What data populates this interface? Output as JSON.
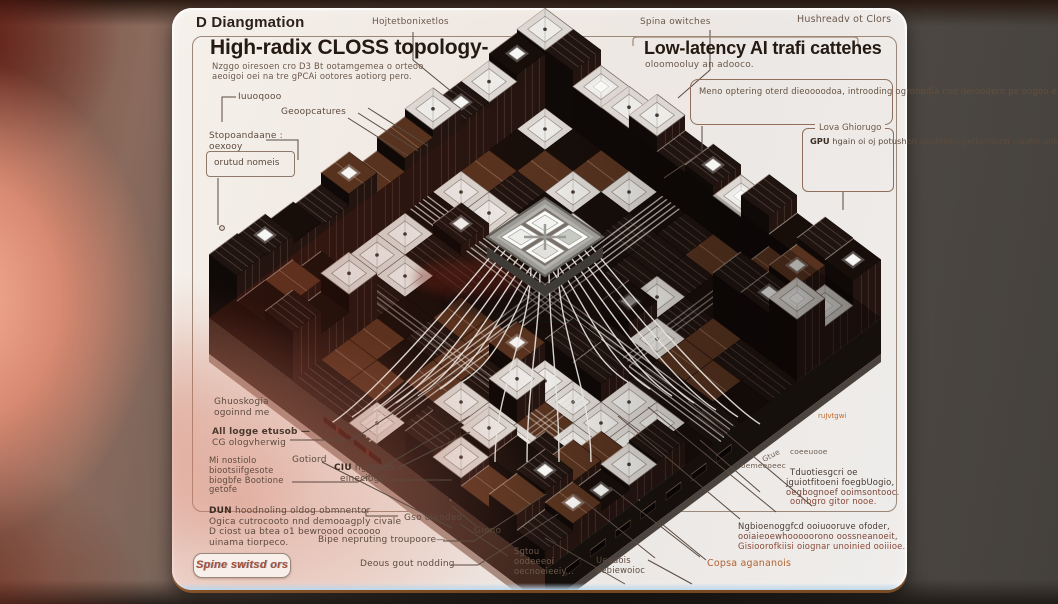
{
  "header": {
    "doc_label": "D Diangmation",
    "center_label": "Hojtetbonixetlos",
    "spine_label": "Spina owitches",
    "right_label": "Hushreadv ot Clors"
  },
  "left_panel": {
    "title": "High-radix CLOSS topology-",
    "subtitle_lines": [
      "Nzggo oiresoen cro D3 Bt ootamgemea o orteoo",
      "aeoigoi oei na tre gPCAi ootores aotiorg pero."
    ],
    "label_top": "Iuuoqooo",
    "label_geo": "Geoopcatures",
    "label_stop_lines": [
      "Stopoandaane :",
      "oexooy"
    ],
    "boxed_label": "orutud nomeis"
  },
  "right_panel": {
    "title": "Low-latency AI trafi cattehes",
    "subtitle": "oloomooluy an adooco.",
    "note_lines": [
      "Meno optering oterd dieoooodoa, introoding",
      "ogronbdia coo deroodero po oogoo enoatio,",
      "noprguroote oooo."
    ],
    "fieldset_legend": "Lova Ghiorugo",
    "fieldset_bold": "GPU",
    "fieldset_line1_rest": " hgain oi oj",
    "fieldset_lines": [
      "potushoit goofoiten",
      "gettoimond ciaofot",
      "onbuomoung ootnd"
    ]
  },
  "annotations_left": {
    "ghuo_lines": [
      "Ghuoskogia",
      "ogoinnd me"
    ],
    "all_lines": [
      "All logge etusob —",
      "CG ologvherwig"
    ],
    "gotiord": "Gotiord",
    "mi_lines": [
      "Mi nostiolo",
      "biootsiifgesote",
      "biogbfe Bootione",
      "getofe"
    ],
    "ciu_bold": "CIU",
    "ciu_rest": " hgeotob",
    "ciu_line2": "eineciogd",
    "dun_bold": "DUN",
    "dun_line1_rest": " hoodnoling oldog obmnentor",
    "dun_lines": [
      "Ogica cutrocooto nnd demooagply civale",
      "D ciost ua btea o1 bewroood ocoooo",
      "uinama tiorpeco."
    ],
    "gso": "Gso olendeo",
    "bipe": "Bipe nepruting troupoore—",
    "spine_box": "Spine switsd ors",
    "deous": "Deous gout nodding"
  },
  "annotations_center": {
    "gieno": "Gieno",
    "sgtou_lines": [
      "Sgtou",
      "oodeeeoi",
      "oecnoeieeiy..."
    ],
    "ueaa_lines": [
      "Ueaaois",
      "aebiewoioc"
    ],
    "copsa": "Copsa agananois",
    "ngb_lines": [
      "Ngbioenoggfcd ooiuooruve ofoder,",
      "ooiaieoewhooooorono oossneanoeit,",
      "Gisioorofkiisi oiognar unoinied ooiiioe."
    ]
  },
  "annotations_right": {
    "gtue": "Gtue",
    "coee": "coeeuooe",
    "oeme": "oemeeoeec",
    "para_lines": [
      "Tduotiesgcri oe",
      "jguiotfitoeni foegbUogio,",
      "oegbognoef ooimsontooc.",
      "oonbgro gitor nooe."
    ]
  },
  "illustration": {
    "port_label": "ruJvtgwi"
  },
  "colors": {
    "accent_orange": "#b3622f",
    "text_dark": "#2c211a",
    "text_body": "#5d4b3f",
    "text_red": "#8a4636",
    "frame_border": "#9b8878"
  }
}
